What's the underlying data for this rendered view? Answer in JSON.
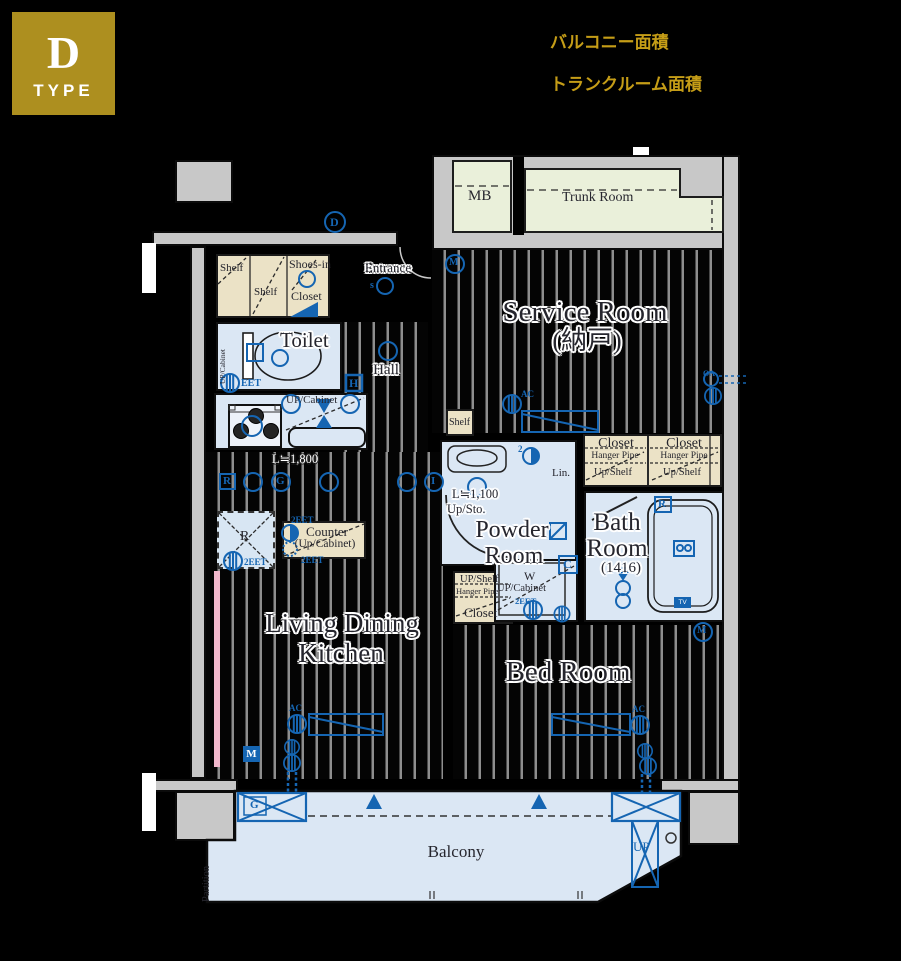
{
  "badge": {
    "letter": "D",
    "type": "TYPE"
  },
  "header": {
    "balcony_area": "バルコニー面積",
    "trunk_area": "トランクルーム面積"
  },
  "top": {
    "mb": "MB",
    "trunk": "Trunk Room"
  },
  "entry": {
    "label": "Entrance",
    "s": "s",
    "d": "D",
    "shelf": "Shelf",
    "shoes_line1": "Shoes-in",
    "shoes_line2": "Closet",
    "hall": "Hall",
    "h": "H"
  },
  "toilet": {
    "label": "Toilet",
    "cabinet": "UP/Cabinet",
    "eet": "EET"
  },
  "kitchen": {
    "cabinet": "UP/Cabinet",
    "length": "L≒1,800",
    "r_box": "R",
    "g": "G",
    "i": "I",
    "fridge_r": "R",
    "fridge_eet": "2EET",
    "counter_line1": "Counter",
    "counter_line2": "(Up/Cabinet)",
    "counter_eet_top": "2EET",
    "counter_eet_bottom": "2EET"
  },
  "service": {
    "line1": "Service Room",
    "line2": "(納戸)",
    "shelf": "Shelf",
    "ac": "AC",
    "m": "M",
    "oa": "OA"
  },
  "closets": {
    "closet": "Closet",
    "hanger": "Hanger Pipe",
    "upshelf": "Up/Shelf"
  },
  "powder": {
    "line1": "Powder",
    "line2": "Room",
    "length": "L≒1,100",
    "upsto": "Up/Sto.",
    "two": "2",
    "lin": "Lin.",
    "c": "C"
  },
  "laundry": {
    "w": "W",
    "cabinet": "UP/Cabinet",
    "eet": "2EET"
  },
  "bathroom": {
    "line1": "Bath",
    "line2": "Room",
    "size": "(1416)",
    "r": "R",
    "tv": "TV"
  },
  "bedcloset": {
    "upshelf": "UP/Shelf",
    "hanger": "Hanger Pipe",
    "closet": "Closet"
  },
  "living": {
    "line1": "Living Dining",
    "line2": "Kitchen",
    "m": "M",
    "ac": "AC"
  },
  "bedroom": {
    "label": "Bed Room",
    "m": "M",
    "ac": "AC"
  },
  "balcony": {
    "label": "Balcony",
    "partition": "Partition",
    "up": "UP",
    "g": "G"
  },
  "colors": {
    "gold_badge": "#ad8f1f",
    "gold_text": "#c59d17",
    "symbol_blue": "#1565b2",
    "wall_gray": "#c8c8c8",
    "room_blue": "#dbe7f4",
    "tan": "#ebe2c6",
    "green": "#eaf0da",
    "pink": "#f2b8cc"
  }
}
